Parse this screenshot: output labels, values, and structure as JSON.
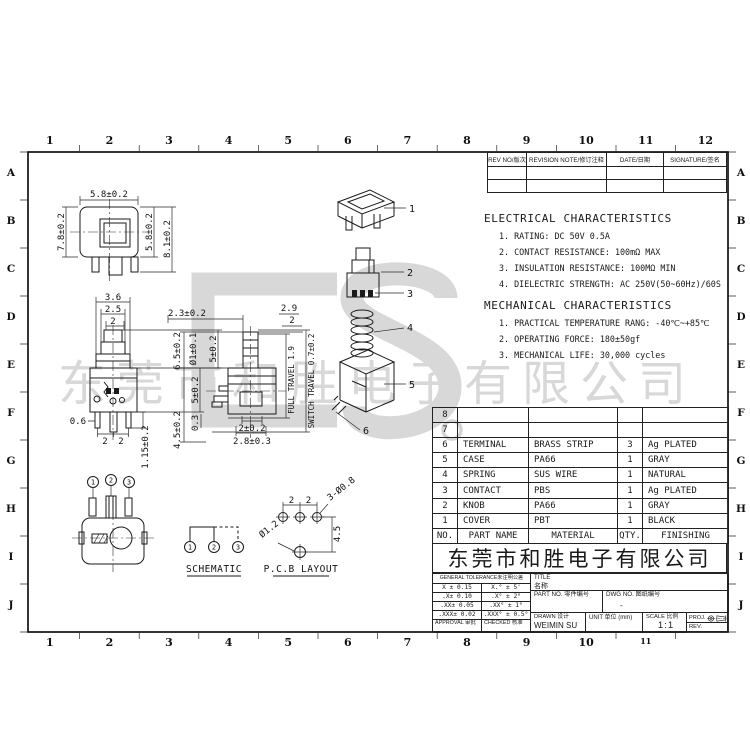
{
  "colors": {
    "line": "#1a1a1a",
    "watermark": "#d8d8d8",
    "background": "#ffffff"
  },
  "frame": {
    "top_ruler": [
      "1",
      "2",
      "3",
      "4",
      "5",
      "6",
      "7",
      "8",
      "9",
      "10",
      "11",
      "12"
    ],
    "bottom_ruler": [
      "1",
      "2",
      "3",
      "4",
      "5",
      "6",
      "7",
      "8",
      "9",
      "10",
      "11"
    ],
    "row_letters": [
      "A",
      "B",
      "C",
      "D",
      "E",
      "F",
      "G",
      "H",
      "I",
      "J"
    ]
  },
  "revision_table": {
    "headers": [
      "REV NO/版次",
      "REVISION NOTE/修订注释",
      "DATE/日期",
      "SIGNATURE/签名"
    ]
  },
  "characteristics": {
    "electrical": {
      "title": "ELECTRICAL CHARACTERISTICS",
      "items": [
        "1. RATING: DC 50V 0.5A",
        "2. CONTACT RESISTANCE: 100mΩ MAX",
        "3. INSULATION RESISTANCE: 100MΩ MIN",
        "4. DIELECTRIC STRENGTH: AC 250V(50~60Hz)/60S"
      ]
    },
    "mechanical": {
      "title": "MECHANICAL CHARACTERISTICS",
      "items": [
        "1. PRACTICAL TEMPERATURE RANG: -40℃~+85℃",
        "2. OPERATING FORCE: 180±50gf",
        "3. MECHANICAL LIFE: 30,000 cycles"
      ]
    }
  },
  "parts_table": {
    "headers": [
      "NO.",
      "PART NAME",
      "MATERIAL",
      "QTY.",
      "FINISHING"
    ],
    "rows": [
      [
        "8",
        "",
        "",
        "",
        ""
      ],
      [
        "7",
        "",
        "",
        "",
        ""
      ],
      [
        "6",
        "TERMINAL",
        "BRASS STRIP",
        "3",
        "Ag PLATED"
      ],
      [
        "5",
        "CASE",
        "PA66",
        "1",
        "GRAY"
      ],
      [
        "4",
        "SPRING",
        "SUS WIRE",
        "1",
        "NATURAL"
      ],
      [
        "3",
        "CONTACT",
        "PBS",
        "1",
        "Ag PLATED"
      ],
      [
        "2",
        "KNOB",
        "PA66",
        "1",
        "GRAY"
      ],
      [
        "1",
        "COVER",
        "PBT",
        "1",
        "BLACK"
      ]
    ]
  },
  "company": {
    "name": "东莞市和胜电子有限公司"
  },
  "watermark": {
    "text": "东莞市和胜电子有限公司"
  },
  "title_block": {
    "tolerance_header": "GENERAL TOLERANCE未注明公差",
    "tolerances": [
      [
        "X ± 0.15",
        "X.° ± 5'"
      ],
      [
        ".X± 0.10",
        ".X° ± 2°"
      ],
      [
        ".XX± 0.05",
        ".XX° ± 1°"
      ],
      [
        ".XXX± 0.02",
        ".XXX° ± 0.5°"
      ]
    ],
    "approval_label": "APPROVAL 审批",
    "checked_label": "CHECKED 核准",
    "title_label": "TITLE",
    "title_cn": "名称",
    "part_no_label": "PART NO. 零件编号",
    "dwg_no_label": "DWG NO. 图纸编号",
    "dwg_no_value": "-",
    "drawn_label": "DRAWN 设计",
    "drawn_value": "WEIMIN SU",
    "unit_label": "UNIT 单位 (mm)",
    "scale_label": "SCALE 比例",
    "scale_value": "1:1",
    "proj_label": "PROJ.",
    "rev_label": "REV."
  },
  "views": {
    "dims": {
      "v1_top": "5.8±0.2",
      "v1_left": "7.8±0.2",
      "v1_r1": "5.8±0.2",
      "v1_r2": "8.1±0.2",
      "v2_w1": "3.6",
      "v2_w2": "2.5",
      "v2_w3": "2",
      "v2_h1": "5±0.2",
      "v2_h2": "5±0.2",
      "v2_pin": "0.6",
      "v2_p1": "2",
      "v2_p2": "2",
      "v2_len": "1.15±0.2",
      "v3_top": "2.3±0.2",
      "v3_k1": "2.9",
      "v3_k2": "2",
      "v3_h1": "6.5±0.2",
      "v3_d1": "Ø1±0.1",
      "v3_h2": "4.5±0.2",
      "v3_d2": "0.3",
      "v3_b1": "2±0.2",
      "v3_b2": "2.8±0.3",
      "travel1": "FULL TRAVEL 1.9",
      "travel2": "SWITCH TRAVEL 0.7±0.2",
      "pcb_p1": "2",
      "pcb_p2": "2",
      "pcb_holes": "3-Ø0.8",
      "pcb_v": "4.5",
      "pcb_hole2": "Ø1.2"
    },
    "callouts": [
      "1",
      "2",
      "3",
      "4",
      "5",
      "6"
    ],
    "terminal_numbers": [
      "1",
      "2",
      "3"
    ],
    "schematic_label": "SCHEMATIC",
    "pcb_label": "P.C.B LAYOUT"
  }
}
